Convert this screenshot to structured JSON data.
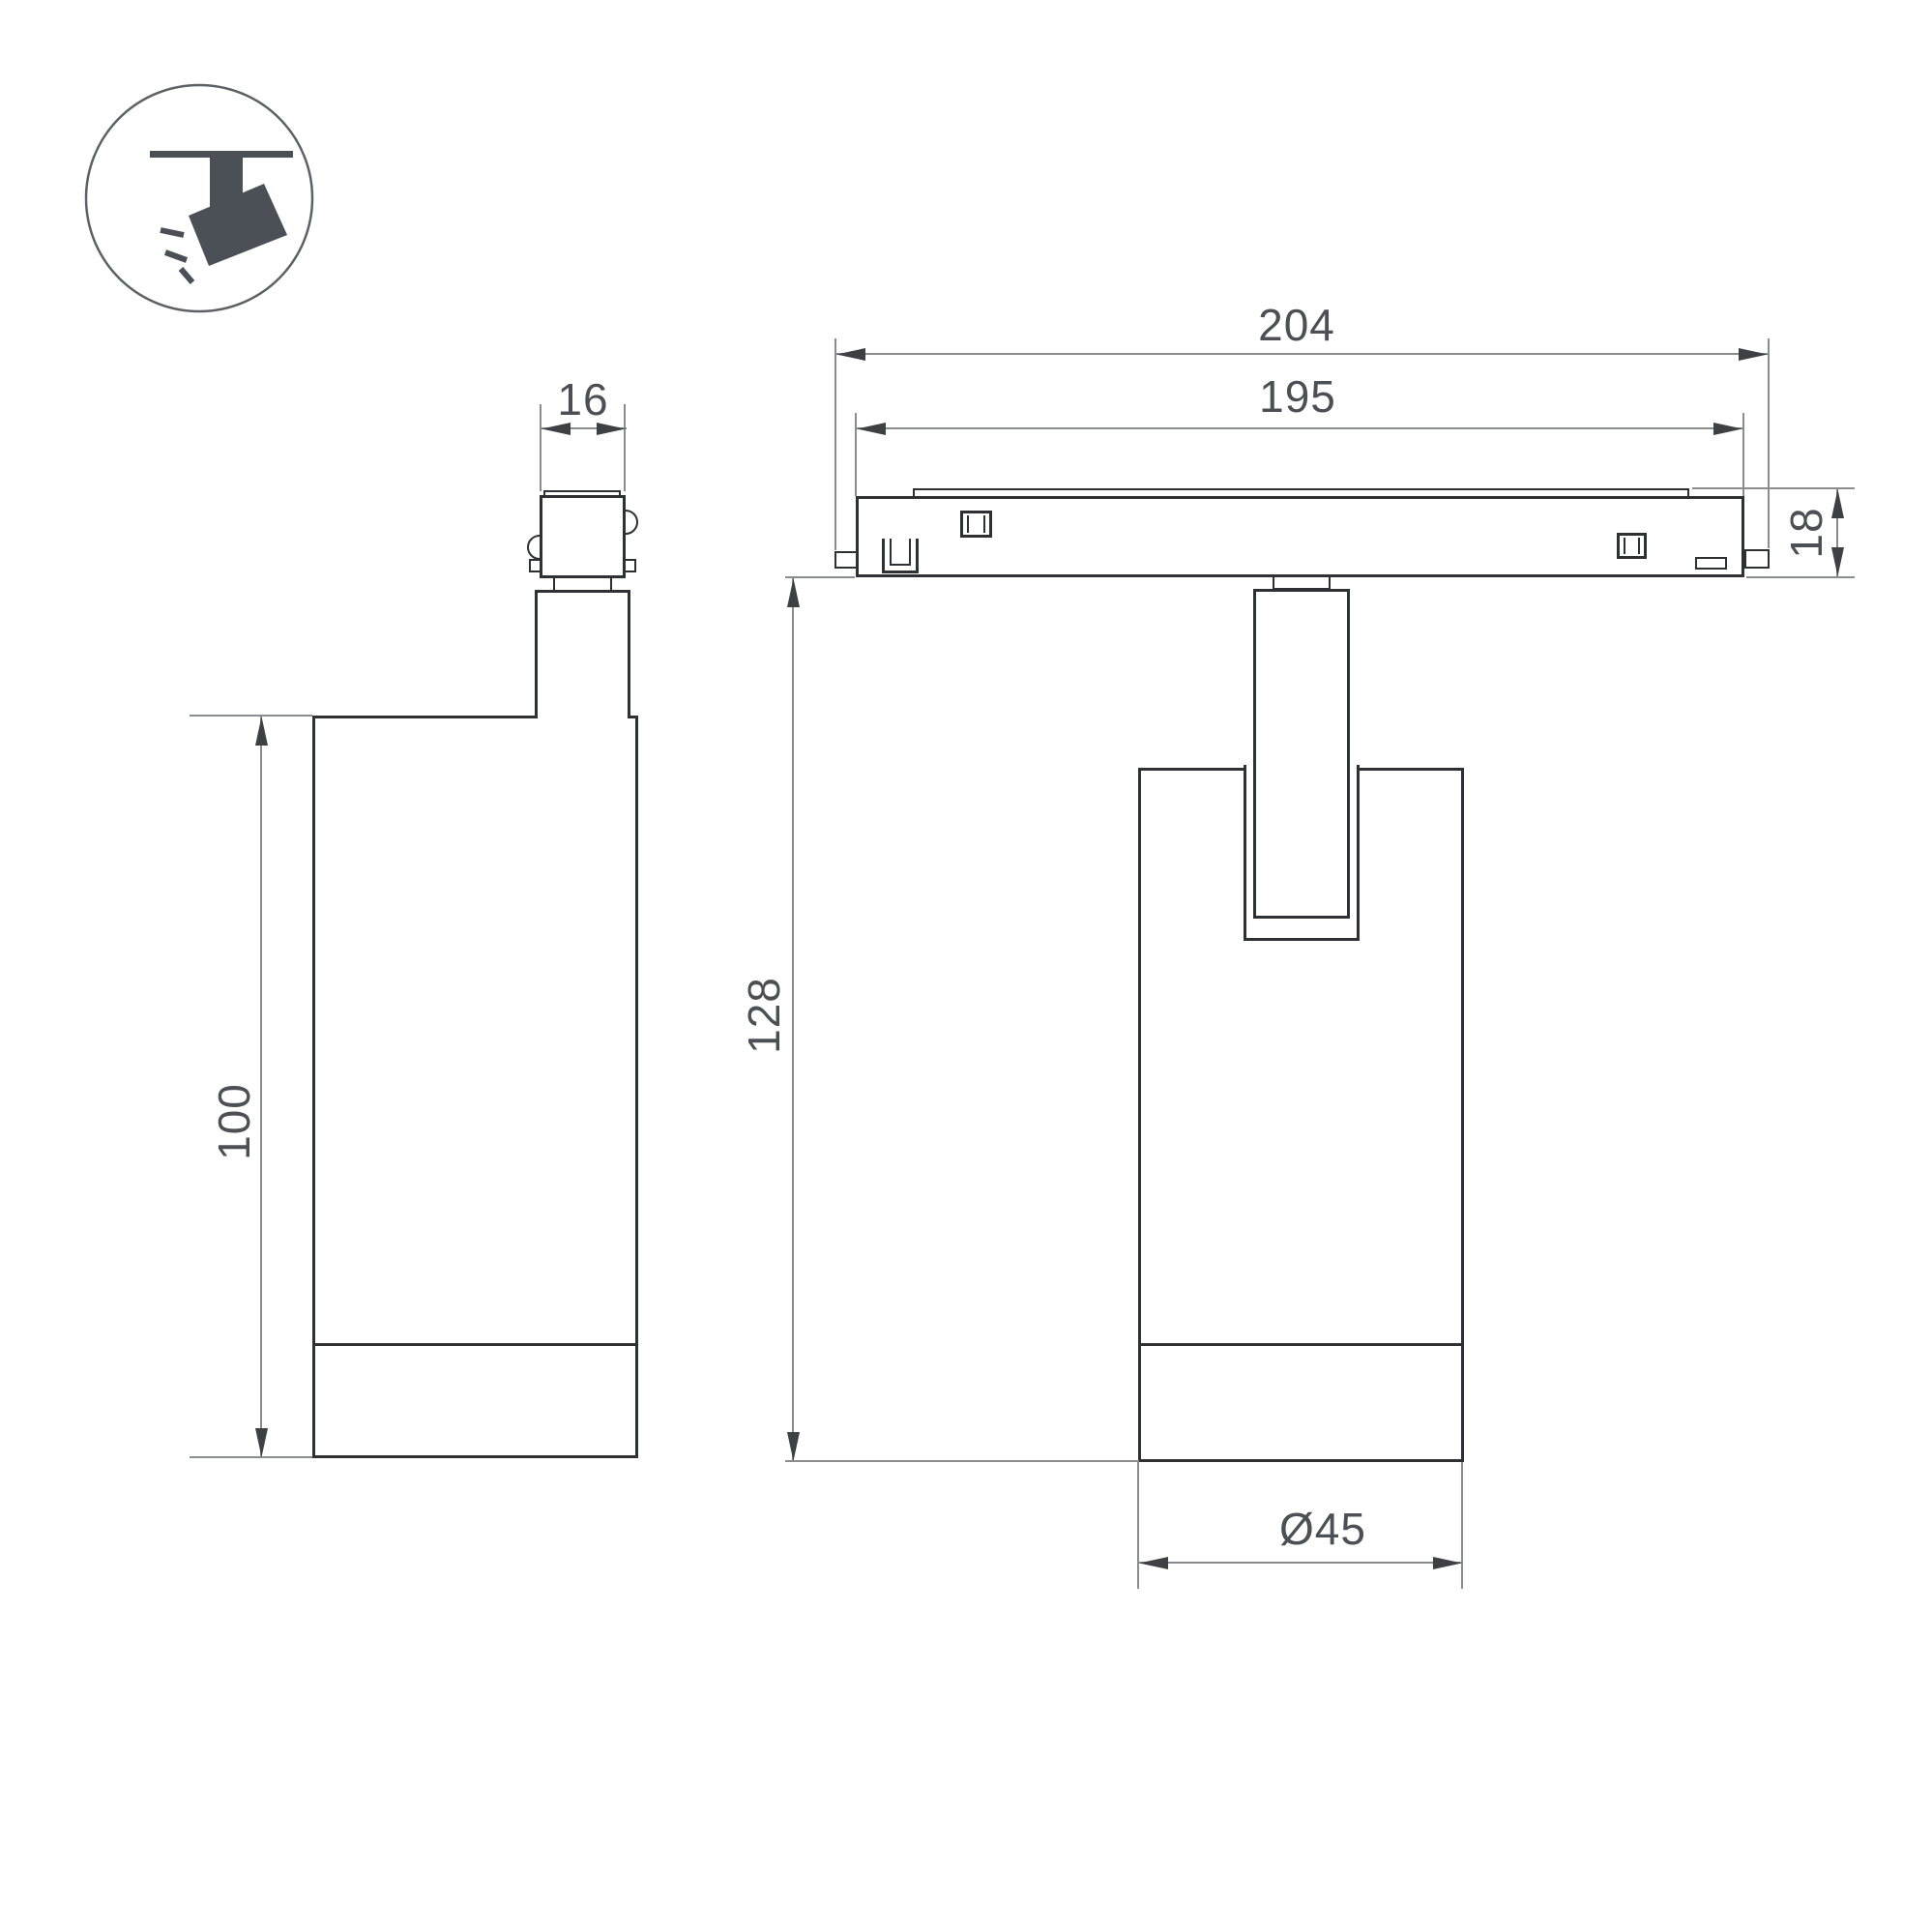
{
  "icon": {
    "name": "track-spotlight-pictogram",
    "color": "#4a5056",
    "circle_stroke": "#5c6165"
  },
  "colors": {
    "outline": "#2d3134",
    "dimension_line": "#898d90",
    "arrowhead": "#3d4144",
    "label_text": "#4c5054",
    "background": "#ffffff"
  },
  "side_view": {
    "name": "spotlight side view",
    "dims": {
      "adapter_width": "16",
      "body_height": "100"
    }
  },
  "front_view": {
    "name": "spotlight on track front view",
    "dims": {
      "overall_length": "204",
      "track_length": "195",
      "track_height": "18",
      "overall_height": "128",
      "body_diameter": "Ø45"
    }
  }
}
